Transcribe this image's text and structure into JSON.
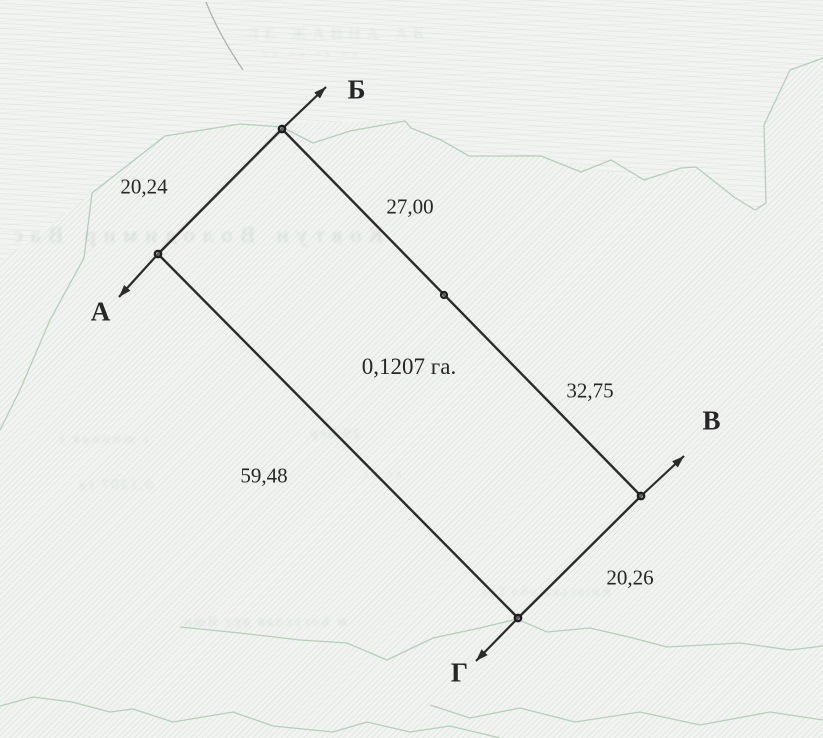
{
  "colors": {
    "ink": "#2b2b2b",
    "contour_green": "#a3c3a8",
    "paper": "#f2f4f1",
    "bleed_through": "#58806c"
  },
  "diagram": {
    "area": {
      "text": "0,1207 га.",
      "center": [
        409,
        367
      ]
    },
    "vertices": [
      {
        "label": "А",
        "x": 158,
        "y": 254,
        "label_center": [
          101,
          312
        ],
        "arrow_tip": [
          119,
          297
        ]
      },
      {
        "label": "Б",
        "x": 282,
        "y": 129,
        "label_center": [
          357,
          90
        ],
        "arrow_tip": [
          326,
          87
        ]
      },
      {
        "label": "В",
        "x": 641,
        "y": 496,
        "label_center": [
          712,
          421
        ],
        "arrow_tip": [
          684,
          456
        ]
      },
      {
        "label": "Г",
        "x": 518,
        "y": 618,
        "label_center": [
          460,
          673
        ],
        "arrow_tip": [
          476,
          661
        ]
      }
    ],
    "edges": [
      {
        "from": 0,
        "to": 1,
        "side": "А-Б"
      },
      {
        "from": 1,
        "to": 2,
        "side": "Б-В"
      },
      {
        "from": 0,
        "to": 3,
        "side": "А-Г"
      },
      {
        "from": 3,
        "to": 2,
        "side": "Г-В"
      }
    ],
    "midpoints": [
      {
        "x": 444,
        "y": 295,
        "on_side": "Б-В"
      }
    ],
    "measurements": [
      {
        "text": "20,24",
        "side": "А-Б",
        "center": [
          144,
          187
        ]
      },
      {
        "text": "27,00",
        "side": "Б-В (верхній)",
        "center": [
          410,
          207
        ]
      },
      {
        "text": "32,75",
        "side": "Б-В (нижній)",
        "center": [
          590,
          391
        ]
      },
      {
        "text": "59,48",
        "side": "А-Г",
        "center": [
          264,
          476
        ]
      },
      {
        "text": "20,26",
        "side": "Г-В",
        "center": [
          630,
          578
        ]
      }
    ],
    "green_contours": [
      [
        [
          0,
          430
        ],
        [
          20,
          390
        ],
        [
          50,
          320
        ],
        [
          84,
          258
        ],
        [
          92,
          193
        ],
        [
          165,
          136
        ],
        [
          240,
          124
        ],
        [
          282,
          127
        ],
        [
          313,
          143
        ],
        [
          350,
          131
        ],
        [
          405,
          121
        ],
        [
          411,
          128
        ],
        [
          441,
          140
        ],
        [
          469,
          156
        ],
        [
          541,
          156
        ],
        [
          581,
          172
        ],
        [
          611,
          160
        ],
        [
          644,
          180
        ],
        [
          681,
          168
        ],
        [
          696,
          167
        ],
        [
          734,
          197
        ],
        [
          755,
          210
        ],
        [
          766,
          203
        ],
        [
          764,
          125
        ],
        [
          790,
          70
        ],
        [
          823,
          58
        ]
      ],
      [
        [
          0,
          706
        ],
        [
          33,
          697
        ],
        [
          72,
          702
        ],
        [
          110,
          712
        ],
        [
          133,
          709
        ],
        [
          173,
          722
        ],
        [
          233,
          712
        ],
        [
          273,
          726
        ],
        [
          333,
          732
        ],
        [
          367,
          722
        ],
        [
          410,
          732
        ],
        [
          450,
          726
        ],
        [
          500,
          738
        ]
      ],
      [
        [
          180,
          627
        ],
        [
          240,
          633
        ],
        [
          300,
          640
        ],
        [
          347,
          643
        ],
        [
          387,
          660
        ],
        [
          433,
          638
        ],
        [
          480,
          628
        ],
        [
          517,
          619
        ],
        [
          547,
          632
        ],
        [
          590,
          628
        ],
        [
          633,
          638
        ],
        [
          667,
          647
        ],
        [
          740,
          643
        ],
        [
          790,
          650
        ],
        [
          823,
          646
        ]
      ],
      [
        [
          430,
          705
        ],
        [
          470,
          718
        ],
        [
          520,
          708
        ],
        [
          575,
          722
        ],
        [
          640,
          712
        ],
        [
          700,
          725
        ],
        [
          770,
          712
        ],
        [
          823,
          720
        ]
      ]
    ],
    "crease": [
      [
        206,
        2
      ],
      [
        215,
        25
      ],
      [
        228,
        48
      ],
      [
        243,
        70
      ]
    ]
  },
  "ghost_texts": [
    {
      "text": "ЛЕ ЖАВНА АК",
      "x": 247,
      "y": 24,
      "size": 17,
      "mirror": false,
      "opacity": 0.1,
      "ls": 6
    },
    {
      "text": "пв на ть на",
      "x": 262,
      "y": 46,
      "size": 12,
      "mirror": false,
      "opacity": 0.09,
      "ls": 4
    },
    {
      "text": "Ковтун Володимир Вас",
      "x": 5,
      "y": 222,
      "size": 22,
      "mirror": true,
      "opacity": 0.16,
      "ls": 8
    },
    {
      "text": "29 бер",
      "x": 308,
      "y": 426,
      "size": 15,
      "mirror": true,
      "opacity": 0.13,
      "ls": 2
    },
    {
      "text": "і шинная і",
      "x": 57,
      "y": 432,
      "size": 14,
      "mirror": true,
      "opacity": 0.12,
      "ls": 3
    },
    {
      "text": "0,1207 га",
      "x": 77,
      "y": 477,
      "size": 15,
      "mirror": true,
      "opacity": 0.13,
      "ls": 2
    },
    {
      "text": "єс ьє",
      "x": 360,
      "y": 466,
      "size": 13,
      "mirror": true,
      "opacity": 0.11,
      "ls": 3
    },
    {
      "text": "Київська обл Гос",
      "x": 478,
      "y": 585,
      "size": 14,
      "mirror": true,
      "opacity": 0.12,
      "ls": 2
    },
    {
      "text": "м Богуслав вул Яшн",
      "x": 182,
      "y": 614,
      "size": 15,
      "mirror": true,
      "opacity": 0.13,
      "ls": 2
    }
  ]
}
